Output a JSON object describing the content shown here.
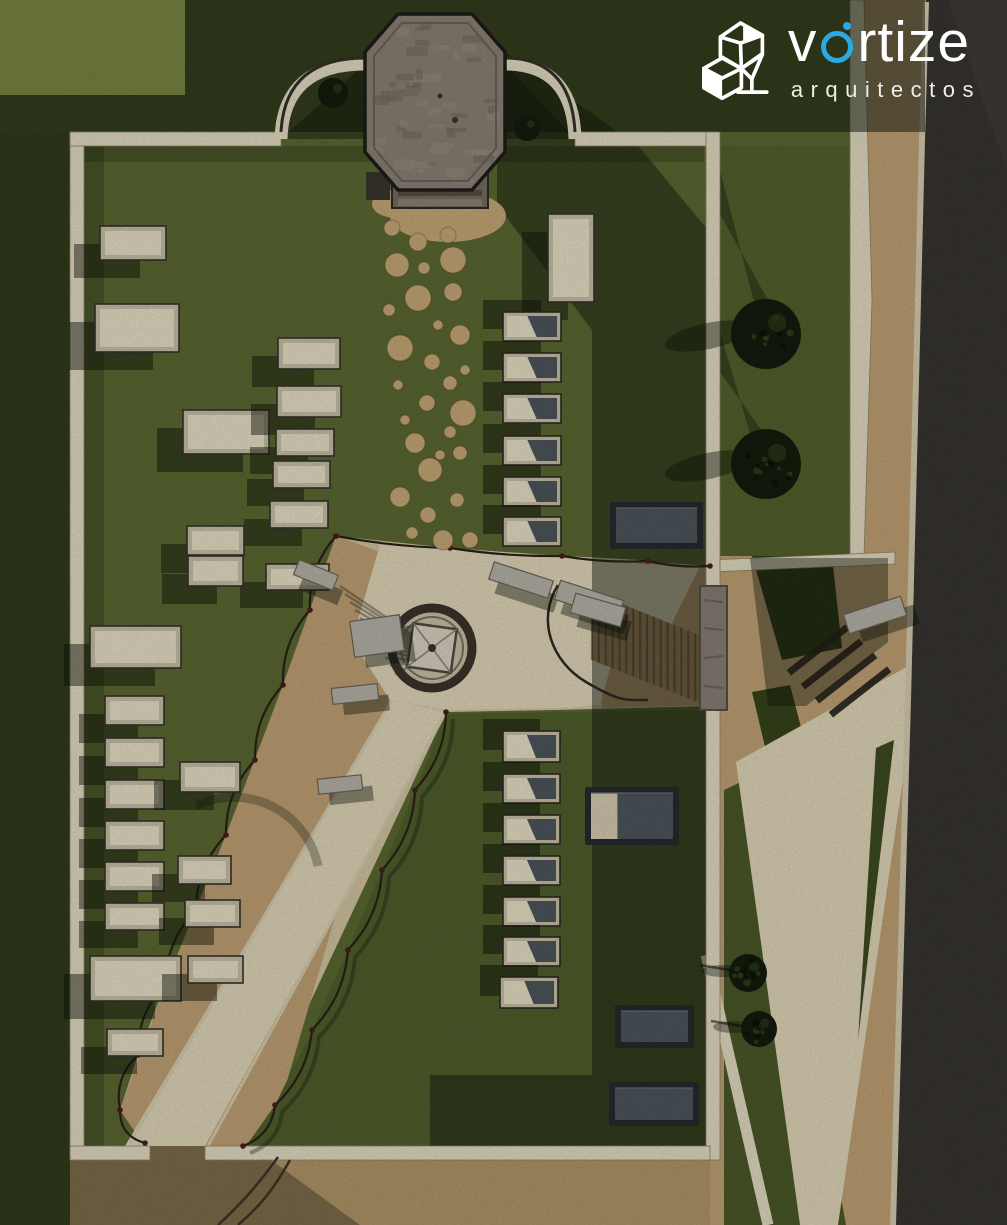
{
  "brand": {
    "word_start": "v",
    "word_end": "rtize",
    "subtitle": "arquitectos",
    "accent_color": "#2BA9E0",
    "text_color": "#ffffff",
    "icon": "vortize-cubes-icon"
  },
  "palette": {
    "grass_base": "#5c6a33",
    "grass_light": "#7b8844",
    "lawn": "#55622e",
    "grass_block": "#51602c",
    "shadow": "#0f170a",
    "wall": "#e7dfc6",
    "wall_edge": "#8f8668",
    "sand_pale": "#e4dabc",
    "sand_mid": "#d6c8a5",
    "sand_tan": "#c3a577",
    "sand_outer": "#b4996a",
    "road": "#393631",
    "curb": "#d9d0b4",
    "stone": "#8d8478",
    "stone_dark": "#5f5a50",
    "slate": "#4e575e",
    "slate_dark": "#262b2e",
    "planter_frame": "#cbc2a8",
    "planter_inner": "#ece3c9",
    "bench": "#bab6ab",
    "tree": "#141c0d",
    "tree_light": "#32411b",
    "fence": "#2b2218",
    "fence_post": "#4a1f1a"
  },
  "scene": {
    "cream_planters": [
      [
        100,
        226,
        66,
        34
      ],
      [
        95,
        304,
        84,
        48
      ],
      [
        183,
        410,
        86,
        44
      ],
      [
        278,
        338,
        62,
        31
      ],
      [
        277,
        386,
        64,
        31
      ],
      [
        276,
        429,
        58,
        27
      ],
      [
        273,
        461,
        57,
        27
      ],
      [
        270,
        501,
        58,
        27
      ],
      [
        266,
        564,
        63,
        26
      ],
      [
        187,
        526,
        57,
        29
      ],
      [
        188,
        556,
        55,
        30
      ],
      [
        90,
        626,
        91,
        42
      ],
      [
        105,
        696,
        59,
        29
      ],
      [
        105,
        738,
        59,
        29
      ],
      [
        105,
        780,
        59,
        29
      ],
      [
        105,
        821,
        59,
        29
      ],
      [
        105,
        862,
        59,
        29
      ],
      [
        105,
        903,
        59,
        27
      ],
      [
        90,
        956,
        91,
        45
      ],
      [
        107,
        1029,
        56,
        27
      ],
      [
        180,
        762,
        60,
        30
      ],
      [
        178,
        856,
        53,
        28
      ],
      [
        185,
        900,
        55,
        27
      ],
      [
        188,
        956,
        55,
        27
      ],
      [
        548,
        214,
        46,
        88
      ]
    ],
    "lidded_planters": [
      [
        503,
        312,
        58,
        29
      ],
      [
        503,
        353,
        58,
        29
      ],
      [
        503,
        394,
        58,
        29
      ],
      [
        503,
        436,
        58,
        29
      ],
      [
        503,
        477,
        58,
        29
      ],
      [
        503,
        517,
        58,
        29
      ],
      [
        503,
        731,
        57,
        31
      ],
      [
        503,
        774,
        57,
        29
      ],
      [
        503,
        815,
        57,
        29
      ],
      [
        503,
        856,
        57,
        29
      ],
      [
        503,
        897,
        57,
        29
      ],
      [
        503,
        937,
        57,
        29
      ],
      [
        500,
        977,
        58,
        31
      ]
    ],
    "dark_tombs": [
      {
        "x": 613,
        "y": 505,
        "w": 87,
        "h": 41,
        "light_left": false
      },
      {
        "x": 588,
        "y": 790,
        "w": 88,
        "h": 52,
        "light_left": true
      },
      {
        "x": 618,
        "y": 1008,
        "w": 73,
        "h": 37,
        "light_left": false
      },
      {
        "x": 612,
        "y": 1085,
        "w": 84,
        "h": 38,
        "light_left": false
      }
    ],
    "benches": [
      [
        490,
        571,
        62,
        18,
        18
      ],
      [
        556,
        590,
        66,
        20,
        18
      ],
      [
        295,
        567,
        42,
        16,
        22
      ],
      [
        332,
        686,
        46,
        16,
        -6
      ],
      [
        318,
        777,
        44,
        15,
        -6
      ],
      [
        572,
        600,
        52,
        20,
        16
      ],
      [
        845,
        605,
        60,
        20,
        -18
      ],
      [
        352,
        618,
        50,
        36,
        -8
      ]
    ],
    "stepping_stones": [
      [
        392,
        228,
        8
      ],
      [
        418,
        242,
        9
      ],
      [
        448,
        235,
        8
      ],
      [
        397,
        265,
        12
      ],
      [
        453,
        260,
        13
      ],
      [
        424,
        268,
        6
      ],
      [
        389,
        310,
        6
      ],
      [
        418,
        298,
        13
      ],
      [
        453,
        292,
        9
      ],
      [
        438,
        325,
        5
      ],
      [
        460,
        335,
        10
      ],
      [
        400,
        348,
        13
      ],
      [
        432,
        362,
        8
      ],
      [
        450,
        383,
        7
      ],
      [
        398,
        385,
        5
      ],
      [
        427,
        403,
        8
      ],
      [
        463,
        413,
        13
      ],
      [
        405,
        420,
        5
      ],
      [
        415,
        443,
        10
      ],
      [
        450,
        432,
        6
      ],
      [
        430,
        470,
        12
      ],
      [
        460,
        453,
        7
      ],
      [
        465,
        370,
        5
      ],
      [
        400,
        497,
        10
      ],
      [
        428,
        515,
        8
      ],
      [
        457,
        500,
        7
      ],
      [
        412,
        533,
        6
      ],
      [
        443,
        540,
        10
      ],
      [
        470,
        540,
        8
      ],
      [
        440,
        455,
        5
      ]
    ],
    "trees_large": [
      [
        766,
        334,
        35
      ],
      [
        766,
        464,
        35
      ]
    ],
    "trees_small": [
      [
        748,
        973,
        19
      ],
      [
        759,
        1029,
        18
      ]
    ],
    "bushes": [
      [
        333,
        93,
        15
      ],
      [
        527,
        128,
        13
      ]
    ],
    "fence_left": [
      [
        336,
        536
      ],
      [
        310,
        610
      ],
      [
        283,
        685
      ],
      [
        255,
        760
      ],
      [
        226,
        835
      ],
      [
        196,
        910
      ],
      [
        165,
        985
      ],
      [
        138,
        1055
      ],
      [
        120,
        1110
      ],
      [
        145,
        1143
      ]
    ],
    "fence_right": [
      [
        446,
        712
      ],
      [
        415,
        790
      ],
      [
        382,
        870
      ],
      [
        348,
        950
      ],
      [
        312,
        1030
      ],
      [
        275,
        1105
      ],
      [
        243,
        1146
      ]
    ],
    "fence_top": [
      [
        336,
        536
      ],
      [
        450,
        548
      ],
      [
        562,
        556
      ],
      [
        648,
        561
      ],
      [
        710,
        566
      ]
    ],
    "steps_bars": [
      [
        818,
        650
      ],
      [
        832,
        664
      ],
      [
        846,
        678
      ],
      [
        860,
        692
      ]
    ],
    "boardwalk": {
      "stripes": 16
    }
  }
}
